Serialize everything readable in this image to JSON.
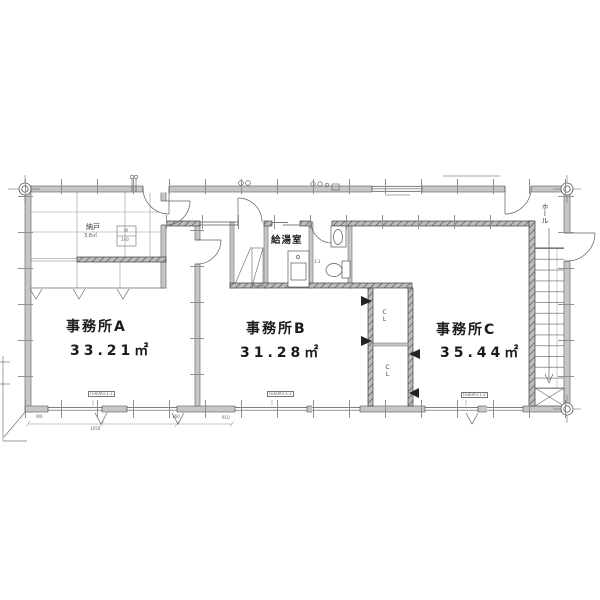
{
  "floor_plan": {
    "rooms": {
      "office_a": {
        "name": "事務所A",
        "area": "33.21㎡"
      },
      "office_b": {
        "name": "事務所B",
        "area": "31.28㎡"
      },
      "office_c": {
        "name": "事務所C",
        "area": "35.44㎡"
      },
      "kitchenette": {
        "name": "給湯室"
      },
      "storage": {
        "name": "納戸",
        "area": "3.8㎡"
      },
      "hall": {
        "name": "ホール"
      },
      "wc": {
        "area": "3.3"
      },
      "closet_upper": {
        "name": "CL"
      },
      "closet_lower": {
        "name": "CL"
      }
    },
    "annotations": {
      "window_tag_a": "FE60A×1-3",
      "window_tag_b": "FE60A×1-3",
      "window_tag_c": "FE60A×1-3",
      "storage_box_top": "W",
      "storage_box_bottom": "240",
      "dim_1": "W6",
      "dim_2": "1650",
      "dim_3": "160",
      "dim_4": "910"
    }
  }
}
